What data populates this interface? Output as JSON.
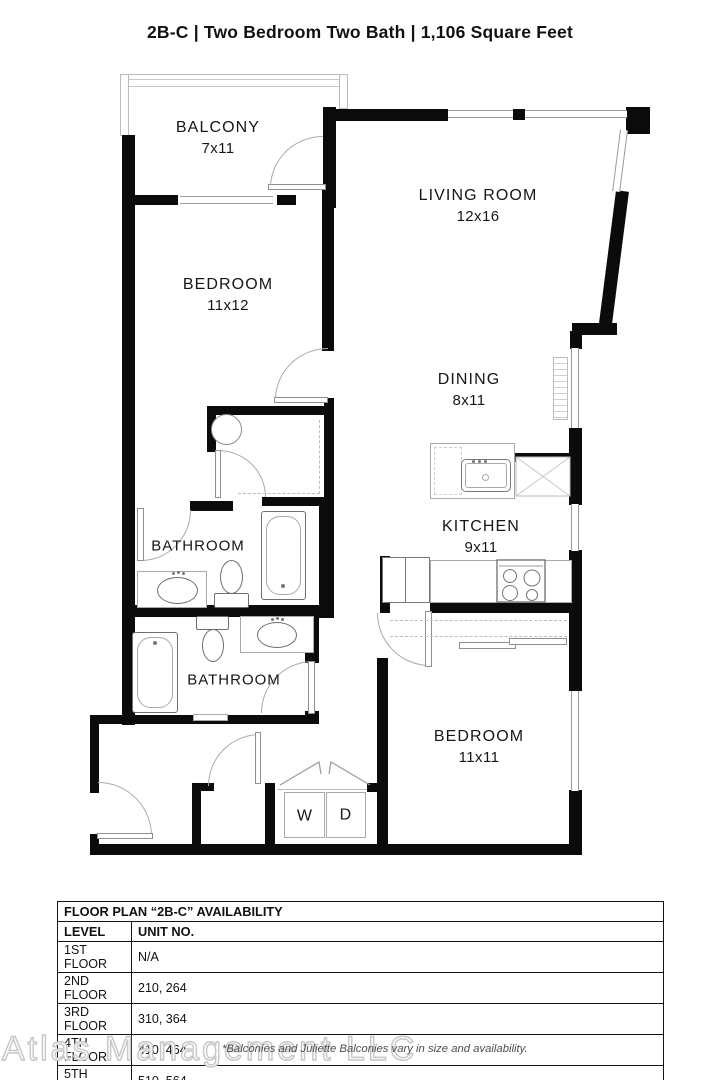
{
  "title": "2B-C | Two Bedroom Two Bath | 1,106 Square Feet",
  "rooms": {
    "balcony": {
      "name": "BALCONY",
      "dims": "7x11"
    },
    "bedroom1": {
      "name": "BEDROOM",
      "dims": "11x12"
    },
    "living": {
      "name": "LIVING ROOM",
      "dims": "12x16"
    },
    "dining": {
      "name": "DINING",
      "dims": "8x11"
    },
    "kitchen": {
      "name": "KITCHEN",
      "dims": "9x11"
    },
    "bathroom1": {
      "name": "BATHROOM"
    },
    "bathroom2": {
      "name": "BATHROOM"
    },
    "bedroom2": {
      "name": "BEDROOM",
      "dims": "11x11"
    },
    "washer": "W",
    "dryer": "D"
  },
  "availability": {
    "title": "FLOOR PLAN “2B-C” AVAILABILITY",
    "columns": {
      "level": "LEVEL",
      "unit": "UNIT NO."
    },
    "rows": [
      {
        "level": "1ST FLOOR",
        "unit": "N/A"
      },
      {
        "level": "2ND FLOOR",
        "unit": "210, 264"
      },
      {
        "level": "3RD FLOOR",
        "unit": "310, 364"
      },
      {
        "level": "4TH FLOOR",
        "unit": "410, 464"
      },
      {
        "level": "5TH FLOOR",
        "unit": "510, 564"
      },
      {
        "level": "6TH FLOOR",
        "unit": "610, 664"
      }
    ]
  },
  "footer": {
    "watermark": "Atlas Management LLC",
    "note": "*Balconies and Juliette Balconies vary in size and availability."
  },
  "colors": {
    "wall": "#0b0b0b",
    "window": "#9a9a9a",
    "watermark": "#c6c6c6"
  }
}
